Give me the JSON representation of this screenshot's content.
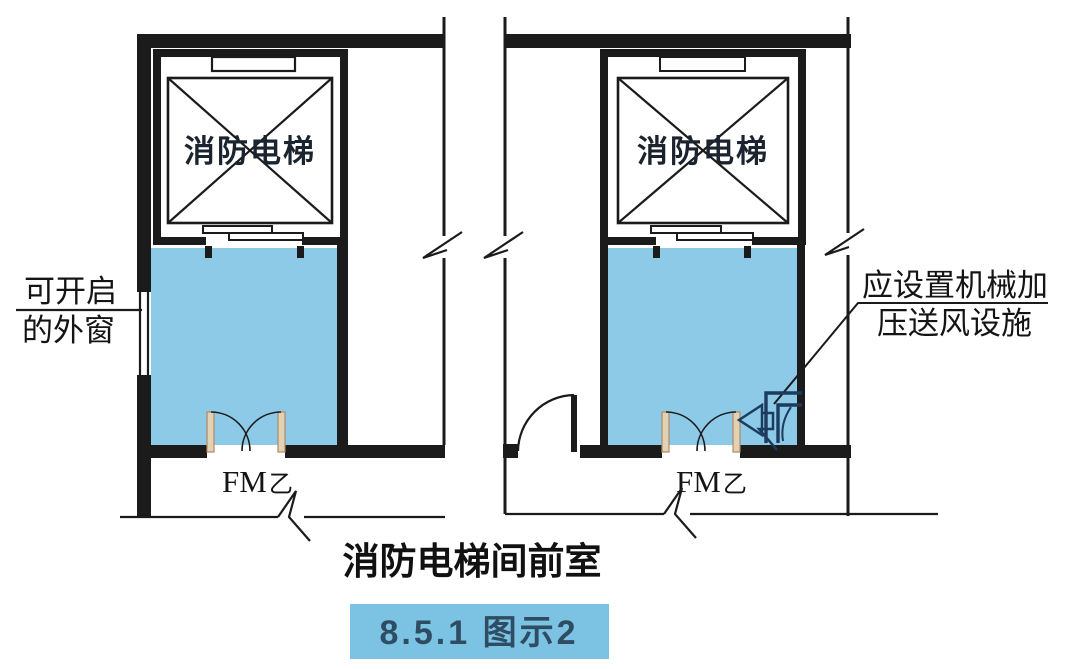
{
  "colors": {
    "room_fill": "#8ccae8",
    "caption_box_fill": "#7cc2e2",
    "caption_box_text": "#2e4d63",
    "wall": "#1b1b1b",
    "duct_symbol": "#1d3b5c",
    "door_leaf_fill": "#e2d2b4"
  },
  "left_diagram": {
    "elevator_label": "消防电梯",
    "room_label": "前室",
    "door_label": "FM",
    "door_label_sub": "乙"
  },
  "right_diagram": {
    "elevator_label": "消防电梯",
    "room_label": "前室",
    "door_label": "FM",
    "door_label_sub": "乙"
  },
  "window_note": {
    "line1": "可开启",
    "line2": "的外窗"
  },
  "mech_note": {
    "line1": "应设置机械加",
    "line2": "压送风设施"
  },
  "caption": {
    "title": "消防电梯间前室",
    "figure_label": "8.5.1 图示2"
  }
}
